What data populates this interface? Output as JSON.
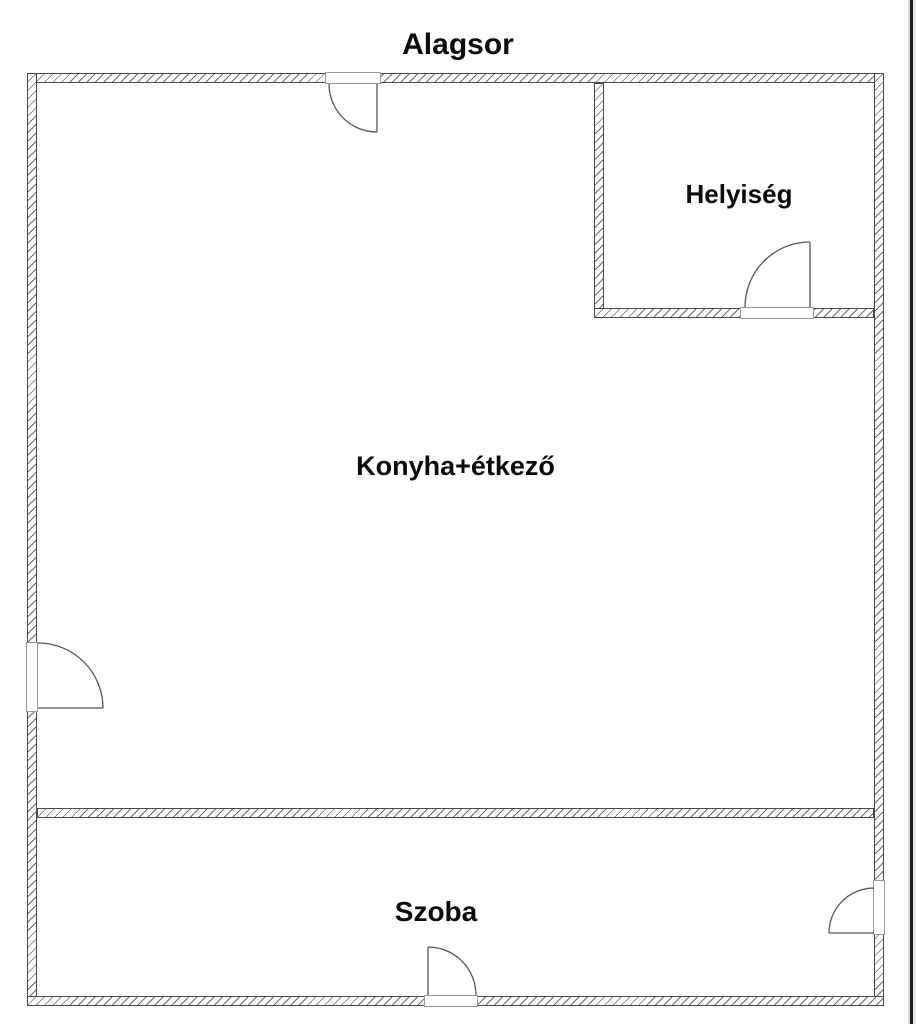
{
  "title": "Alagsor",
  "rooms": [
    {
      "id": "helyiseg",
      "label": "Helyiség"
    },
    {
      "id": "konyha-etkezo",
      "label": "Konyha+étkező"
    },
    {
      "id": "szoba",
      "label": "Szoba"
    }
  ],
  "doors_count": 5,
  "colors": {
    "background": "#ffffff",
    "wall_outline": "#4a4a4a",
    "wall_hatch": "#6a6a6a",
    "door_line": "#555555",
    "text": "#0b0b0b",
    "page_edge_dark": "#1b1b1b",
    "page_edge_light": "#e9e9e9"
  }
}
